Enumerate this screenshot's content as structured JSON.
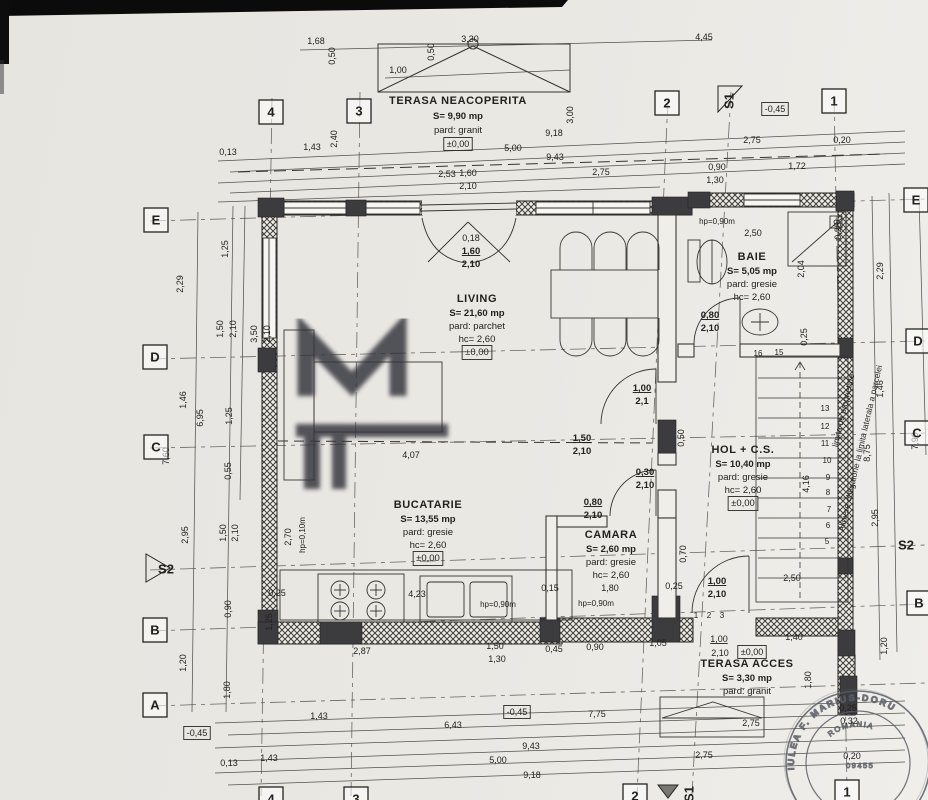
{
  "colors": {
    "paper": "#e9e7e2",
    "ink": "#23211d",
    "wall_dark": "#3c3b3e",
    "stamp": "#5a5e66",
    "watermark": "#31323a"
  },
  "rooms": [
    {
      "x": 458,
      "y": 104,
      "gap": 14,
      "lines": [
        {
          "t": "TERASA NEACOPERITA",
          "name": 1
        },
        {
          "t": "S= 9,90 mp",
          "b": 1
        },
        {
          "t": "pard: granit"
        }
      ]
    },
    {
      "x": 477,
      "y": 302,
      "gap": 13,
      "lines": [
        {
          "t": "LIVING",
          "name": 1
        },
        {
          "t": "S= 21,60 mp",
          "b": 1
        },
        {
          "t": "pard: parchet"
        },
        {
          "t": "hc= 2,60"
        },
        {
          "t": "±0,00",
          "box": 1
        }
      ]
    },
    {
      "x": 752,
      "y": 260,
      "gap": 13,
      "lines": [
        {
          "t": "BAIE",
          "name": 1
        },
        {
          "t": "S= 5,05 mp",
          "b": 1
        },
        {
          "t": "pard: gresie"
        },
        {
          "t": "hc= 2,60"
        }
      ]
    },
    {
      "x": 743,
      "y": 453,
      "gap": 13,
      "lines": [
        {
          "t": "HOL + C.S.",
          "name": 1
        },
        {
          "t": "S= 10,40 mp",
          "b": 1
        },
        {
          "t": "pard: gresie"
        },
        {
          "t": "hc= 2,60"
        },
        {
          "t": "±0,00",
          "box": 1
        }
      ]
    },
    {
      "x": 428,
      "y": 508,
      "gap": 13,
      "lines": [
        {
          "t": "BUCATARIE",
          "name": 1
        },
        {
          "t": "S= 13,55 mp",
          "b": 1
        },
        {
          "t": "pard: gresie"
        },
        {
          "t": "hc= 2,60"
        },
        {
          "t": "±0,00",
          "box": 1
        }
      ]
    },
    {
      "x": 611,
      "y": 538,
      "gap": 13,
      "lines": [
        {
          "t": "CAMARA",
          "name": 1
        },
        {
          "t": "S= 2,60 mp",
          "b": 1
        },
        {
          "t": "pard: gresie"
        },
        {
          "t": "hc= 2,60"
        }
      ]
    },
    {
      "x": 747,
      "y": 667,
      "gap": 13,
      "lines": [
        {
          "t": "TERASA ACCES",
          "name": 1
        },
        {
          "t": "S= 3,30 mp",
          "b": 1
        },
        {
          "t": "pard: granit"
        }
      ]
    }
  ],
  "grid_markers": [
    {
      "l": "4",
      "x": 271,
      "y": 112
    },
    {
      "l": "3",
      "x": 359,
      "y": 111
    },
    {
      "l": "2",
      "x": 667,
      "y": 103
    },
    {
      "l": "S1",
      "x": 729,
      "y": 101,
      "r": -90,
      "nobox": 1,
      "flag": "right"
    },
    {
      "l": "1",
      "x": 834,
      "y": 101
    },
    {
      "l": "E",
      "x": 156,
      "y": 220
    },
    {
      "l": "D",
      "x": 155,
      "y": 357
    },
    {
      "l": "C",
      "x": 156,
      "y": 447
    },
    {
      "l": "S2",
      "x": 166,
      "y": 569,
      "nobox": 1,
      "flag": "left"
    },
    {
      "l": "B",
      "x": 155,
      "y": 630
    },
    {
      "l": "A",
      "x": 155,
      "y": 705
    },
    {
      "l": "E",
      "x": 916,
      "y": 200
    },
    {
      "l": "D",
      "x": 918,
      "y": 341
    },
    {
      "l": "C",
      "x": 917,
      "y": 433
    },
    {
      "l": "S2",
      "x": 906,
      "y": 545,
      "nobox": 1
    },
    {
      "l": "B",
      "x": 919,
      "y": 603
    },
    {
      "l": "4",
      "x": 271,
      "y": 799
    },
    {
      "l": "3",
      "x": 356,
      "y": 799
    },
    {
      "l": "2",
      "x": 635,
      "y": 796
    },
    {
      "l": "S1",
      "x": 689,
      "y": 794,
      "r": -90,
      "nobox": 1
    },
    {
      "l": "1",
      "x": 847,
      "y": 792
    }
  ],
  "dimensions": [
    {
      "t": "1,68",
      "x": 316,
      "y": 44
    },
    {
      "t": "0,50",
      "x": 335,
      "y": 56,
      "r": -90
    },
    {
      "t": "1,00",
      "x": 398,
      "y": 73
    },
    {
      "t": "0,50",
      "x": 434,
      "y": 52,
      "r": -90
    },
    {
      "t": "3,30",
      "x": 470,
      "y": 42
    },
    {
      "t": "4,45",
      "x": 704,
      "y": 40
    },
    {
      "t": "3,00",
      "x": 573,
      "y": 115,
      "r": -90
    },
    {
      "t": "2,40",
      "x": 337,
      "y": 139,
      "r": -90
    },
    {
      "t": "0,13",
      "x": 228,
      "y": 155
    },
    {
      "t": "1,43",
      "x": 312,
      "y": 150
    },
    {
      "t": "9,18",
      "x": 554,
      "y": 136
    },
    {
      "t": "±0,00",
      "x": 458,
      "y": 147,
      "box": 1
    },
    {
      "t": "5,00",
      "x": 513,
      "y": 151
    },
    {
      "t": "9,43",
      "x": 555,
      "y": 160
    },
    {
      "t": "2,53",
      "x": 447,
      "y": 177
    },
    {
      "t": "1,60",
      "x": 468,
      "y": 176
    },
    {
      "t": "2,10",
      "x": 468,
      "y": 189
    },
    {
      "t": "2,75",
      "x": 601,
      "y": 175
    },
    {
      "t": "2,75",
      "x": 752,
      "y": 143
    },
    {
      "t": "0,20",
      "x": 842,
      "y": 143
    },
    {
      "t": "0,90",
      "x": 717,
      "y": 170
    },
    {
      "t": "1,72",
      "x": 797,
      "y": 169
    },
    {
      "t": "1,30",
      "x": 715,
      "y": 183
    },
    {
      "t": "-0,45",
      "x": 775,
      "y": 112,
      "box": 1
    },
    {
      "t": "1,25",
      "x": 228,
      "y": 249,
      "r": -90
    },
    {
      "t": "2,29",
      "x": 183,
      "y": 284,
      "r": -90
    },
    {
      "t": "1,50",
      "x": 223,
      "y": 329,
      "r": -90
    },
    {
      "t": "2,10",
      "x": 236,
      "y": 329,
      "r": -90
    },
    {
      "t": "3,50",
      "x": 257,
      "y": 334,
      "r": -90
    },
    {
      "t": "2,10",
      "x": 270,
      "y": 334,
      "r": -90
    },
    {
      "t": "1,46",
      "x": 186,
      "y": 400,
      "r": -90
    },
    {
      "t": "6,95",
      "x": 203,
      "y": 418,
      "r": -90
    },
    {
      "t": "1,25",
      "x": 232,
      "y": 416,
      "r": -90
    },
    {
      "t": "7,60",
      "x": 169,
      "y": 456,
      "r": -90
    },
    {
      "t": "0,55",
      "x": 231,
      "y": 471,
      "r": -90
    },
    {
      "t": "2,95",
      "x": 188,
      "y": 535,
      "r": -90
    },
    {
      "t": "1,50",
      "x": 226,
      "y": 533,
      "r": -90
    },
    {
      "t": "2,10",
      "x": 238,
      "y": 533,
      "r": -90
    },
    {
      "t": "0,90",
      "x": 231,
      "y": 609,
      "r": -90
    },
    {
      "t": "1,20",
      "x": 186,
      "y": 663,
      "r": -90
    },
    {
      "t": "1,80",
      "x": 230,
      "y": 690,
      "r": -90
    },
    {
      "t": "-0,45",
      "x": 197,
      "y": 736,
      "box": 1
    },
    {
      "t": "2,29",
      "x": 883,
      "y": 271,
      "r": -90
    },
    {
      "t": "1,46",
      "x": 883,
      "y": 389,
      "r": -90
    },
    {
      "t": "7,90",
      "x": 918,
      "y": 441,
      "r": -90
    },
    {
      "t": "8,75",
      "x": 870,
      "y": 453,
      "r": -90
    },
    {
      "t": "2,95",
      "x": 878,
      "y": 518,
      "r": -90
    },
    {
      "t": "1,20",
      "x": 887,
      "y": 646,
      "r": -90
    },
    {
      "t": "0,25",
      "x": 841,
      "y": 231,
      "r": -90
    },
    {
      "t": "2,04",
      "x": 804,
      "y": 269,
      "r": -90
    },
    {
      "t": "0,25",
      "x": 807,
      "y": 337,
      "r": -90
    },
    {
      "t": "4,16",
      "x": 809,
      "y": 484,
      "r": -90
    },
    {
      "t": "0,18",
      "x": 471,
      "y": 241
    },
    {
      "t": "1,60",
      "x": 471,
      "y": 254,
      "u": 1,
      "b": 1
    },
    {
      "t": "2,10",
      "x": 471,
      "y": 267,
      "b": 1
    },
    {
      "t": "hp=0,90m",
      "x": 717,
      "y": 224,
      "sm": 1
    },
    {
      "t": "2,50",
      "x": 753,
      "y": 236
    },
    {
      "t": "0,80",
      "x": 710,
      "y": 318,
      "u": 1,
      "b": 1
    },
    {
      "t": "2,10",
      "x": 710,
      "y": 331,
      "b": 1
    },
    {
      "t": "1,00",
      "x": 642,
      "y": 391,
      "u": 1,
      "b": 1
    },
    {
      "t": "2,1",
      "x": 642,
      "y": 404,
      "b": 1
    },
    {
      "t": "0,50",
      "x": 684,
      "y": 438,
      "r": -90
    },
    {
      "t": "1,50",
      "x": 582,
      "y": 441,
      "u": 1,
      "b": 1
    },
    {
      "t": "2,10",
      "x": 582,
      "y": 454,
      "b": 1
    },
    {
      "t": "4,07",
      "x": 411,
      "y": 458
    },
    {
      "t": "0,30",
      "x": 645,
      "y": 475,
      "u": 1,
      "b": 1
    },
    {
      "t": "2,10",
      "x": 645,
      "y": 488,
      "b": 1
    },
    {
      "t": "0,80",
      "x": 593,
      "y": 505,
      "u": 1,
      "b": 1
    },
    {
      "t": "2,10",
      "x": 593,
      "y": 518,
      "b": 1
    },
    {
      "t": "2,70",
      "x": 291,
      "y": 537,
      "r": -90
    },
    {
      "t": "hp=0,10m",
      "x": 305,
      "y": 535,
      "r": -90,
      "sm": 1
    },
    {
      "t": "0,15",
      "x": 550,
      "y": 591
    },
    {
      "t": "1,80",
      "x": 610,
      "y": 591
    },
    {
      "t": "0,25",
      "x": 674,
      "y": 589
    },
    {
      "t": "hp=0,90m",
      "x": 596,
      "y": 606,
      "sm": 1
    },
    {
      "t": "hp=0,90m",
      "x": 498,
      "y": 607,
      "sm": 1
    },
    {
      "t": "4,23",
      "x": 417,
      "y": 597
    },
    {
      "t": "0,25",
      "x": 277,
      "y": 596
    },
    {
      "t": "1,25",
      "x": 272,
      "y": 622,
      "r": -90
    },
    {
      "t": "0,70",
      "x": 686,
      "y": 554,
      "r": -90
    },
    {
      "t": "1,00",
      "x": 717,
      "y": 584,
      "u": 1,
      "b": 1
    },
    {
      "t": "2,10",
      "x": 717,
      "y": 597,
      "b": 1
    },
    {
      "t": "2,50",
      "x": 792,
      "y": 581
    },
    {
      "t": "2,87",
      "x": 362,
      "y": 654
    },
    {
      "t": "1,50",
      "x": 495,
      "y": 649
    },
    {
      "t": "1,30",
      "x": 497,
      "y": 662
    },
    {
      "t": "0,45",
      "x": 554,
      "y": 652
    },
    {
      "t": "0,90",
      "x": 595,
      "y": 650
    },
    {
      "t": "1,05",
      "x": 658,
      "y": 646
    },
    {
      "t": "1,00",
      "x": 719,
      "y": 642,
      "u": 1
    },
    {
      "t": "2,10",
      "x": 720,
      "y": 656
    },
    {
      "t": "±0,00",
      "x": 752,
      "y": 655,
      "box": 1
    },
    {
      "t": "1,40",
      "x": 794,
      "y": 640
    },
    {
      "t": "1,80",
      "x": 811,
      "y": 680,
      "r": -90
    },
    {
      "t": "2,75",
      "x": 751,
      "y": 726
    },
    {
      "t": "0,25",
      "x": 848,
      "y": 711
    },
    {
      "t": "0,32",
      "x": 849,
      "y": 724
    },
    {
      "t": "0,20",
      "x": 852,
      "y": 759
    },
    {
      "t": "1,43",
      "x": 319,
      "y": 719
    },
    {
      "t": "-0,45",
      "x": 517,
      "y": 715,
      "box": 1
    },
    {
      "t": "7,75",
      "x": 597,
      "y": 717
    },
    {
      "t": "6,43",
      "x": 453,
      "y": 728
    },
    {
      "t": "9,43",
      "x": 531,
      "y": 749
    },
    {
      "t": "5,00",
      "x": 498,
      "y": 763
    },
    {
      "t": "0,13",
      "x": 229,
      "y": 766
    },
    {
      "t": "1,43",
      "x": 269,
      "y": 761
    },
    {
      "t": "9,18",
      "x": 532,
      "y": 778
    },
    {
      "t": "2,75",
      "x": 704,
      "y": 758
    },
    {
      "t": "16",
      "x": 758,
      "y": 356,
      "sm": 1
    },
    {
      "t": "15",
      "x": 779,
      "y": 355,
      "sm": 1
    },
    {
      "t": "13",
      "x": 825,
      "y": 411,
      "sm": 1
    },
    {
      "t": "12",
      "x": 825,
      "y": 429,
      "sm": 1
    },
    {
      "t": "11",
      "x": 825,
      "y": 446,
      "sm": 1
    },
    {
      "t": "10",
      "x": 827,
      "y": 463,
      "sm": 1
    },
    {
      "t": "9",
      "x": 828,
      "y": 480,
      "sm": 1
    },
    {
      "t": "8",
      "x": 828,
      "y": 495,
      "sm": 1
    },
    {
      "t": "7",
      "x": 829,
      "y": 512,
      "sm": 1
    },
    {
      "t": "6",
      "x": 828,
      "y": 528,
      "sm": 1
    },
    {
      "t": "5",
      "x": 827,
      "y": 544,
      "sm": 1
    },
    {
      "t": "1",
      "x": 696,
      "y": 618,
      "sm": 1
    },
    {
      "t": "2",
      "x": 709,
      "y": 618,
      "sm": 1
    },
    {
      "t": "3",
      "x": 722,
      "y": 618,
      "sm": 1
    }
  ],
  "site_notes": [
    {
      "t": "limita de proprietate",
      "x": 846,
      "y": 411,
      "r": -77
    },
    {
      "t": "Aliniere obligatorie la limita laterala a parcelei",
      "x": 863,
      "y": 449,
      "r": -77
    }
  ],
  "stamp": {
    "outer": "IULEA F. MARIUS-DORU",
    "inner": "ROMANIA",
    "number": "09455"
  }
}
